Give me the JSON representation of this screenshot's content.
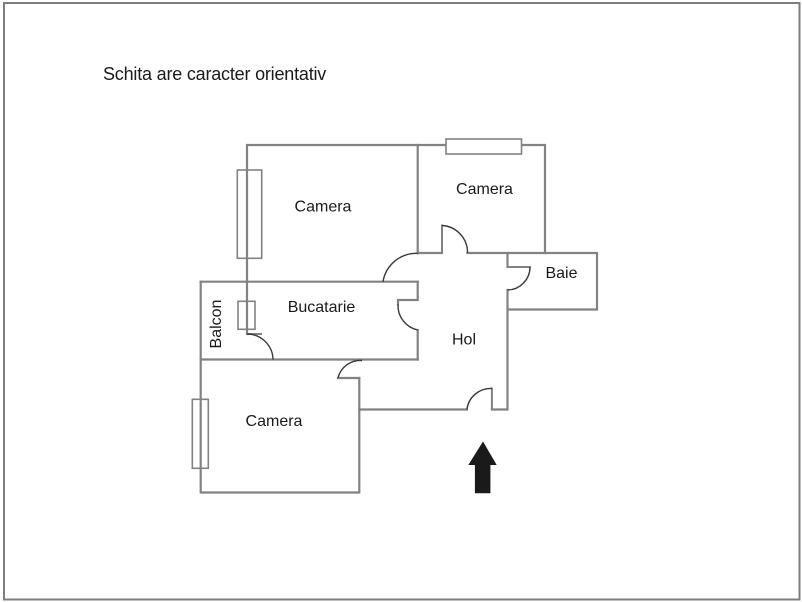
{
  "title": "Schita are caracter orientativ",
  "rooms": {
    "camera_top_left": "Camera",
    "camera_top_right": "Camera",
    "baie": "Baie",
    "bucatarie": "Bucatarie",
    "hol": "Hol",
    "balcon": "Balcon",
    "camera_bottom": "Camera"
  },
  "entrance": {
    "marker": "up-arrow"
  },
  "colors": {
    "wall": "#828282",
    "door": "#3a3a3a",
    "text": "#1a1a1a",
    "arrow": "#1a1a1a",
    "border": "#7d7d7d"
  }
}
